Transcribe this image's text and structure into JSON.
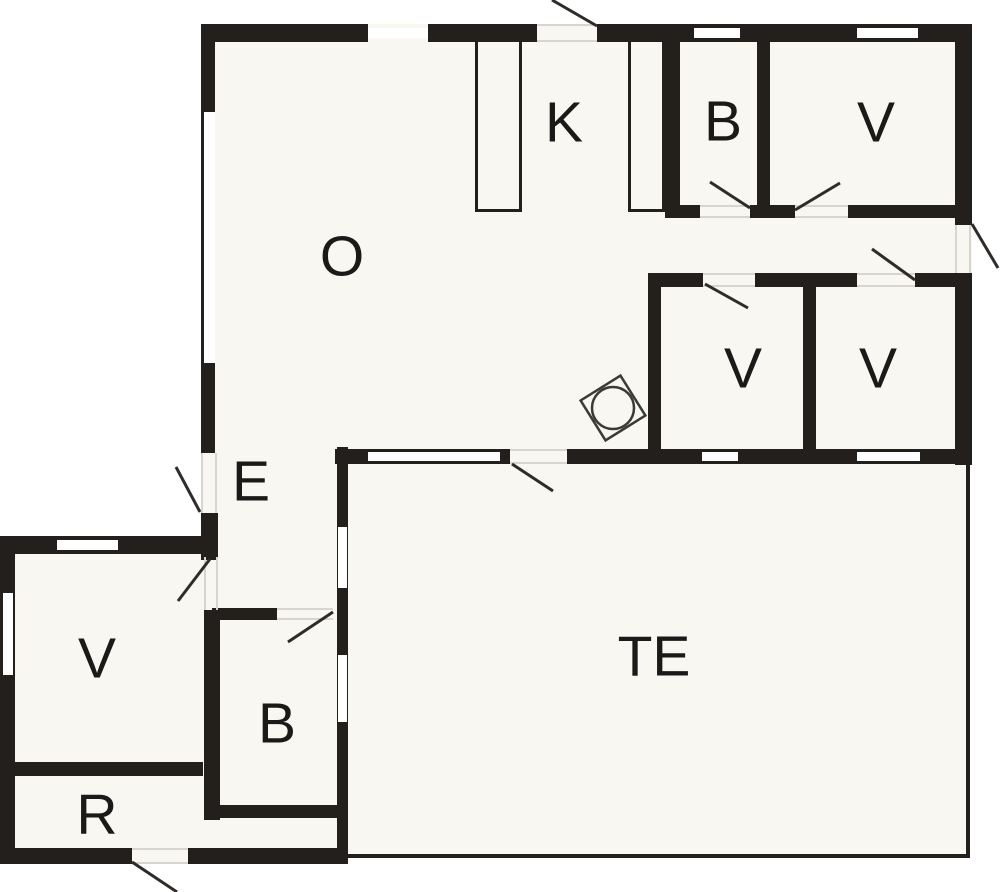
{
  "canvas": {
    "width": 1000,
    "height": 892
  },
  "colors": {
    "background": "#ffffff",
    "floor": "#f8f7f2",
    "wall": "#221f1c",
    "swing_line": "#2e2b28",
    "hairline": "#d8d5ce",
    "label": "#1c1a18",
    "washer_stroke": "#3a3a38"
  },
  "label_font_size": 57,
  "rooms": [
    {
      "id": "living-room",
      "label": "O",
      "x": 342,
      "y": 257
    },
    {
      "id": "kitchen",
      "label": "K",
      "x": 564,
      "y": 123
    },
    {
      "id": "bathroom-top",
      "label": "B",
      "x": 723,
      "y": 122
    },
    {
      "id": "bedroom-top-right",
      "label": "V",
      "x": 876,
      "y": 123
    },
    {
      "id": "bedroom-mid-left",
      "label": "V",
      "x": 743,
      "y": 369
    },
    {
      "id": "bedroom-mid-right",
      "label": "V",
      "x": 878,
      "y": 369
    },
    {
      "id": "entrance",
      "label": "E",
      "x": 251,
      "y": 482
    },
    {
      "id": "bedroom-lower-left",
      "label": "V",
      "x": 97,
      "y": 659
    },
    {
      "id": "storage-room",
      "label": "R",
      "x": 97,
      "y": 815
    },
    {
      "id": "bathroom-bottom",
      "label": "B",
      "x": 277,
      "y": 724
    },
    {
      "id": "terrace",
      "label": "TE",
      "x": 654,
      "y": 657
    }
  ],
  "fills": [
    [
      201,
      24,
      771,
      441
    ],
    [
      201,
      449,
      147,
      171
    ],
    [
      0,
      536,
      348,
      328
    ],
    [
      337,
      447,
      633,
      411
    ]
  ],
  "walls": [
    [
      201,
      24,
      167,
      18
    ],
    [
      428,
      24,
      109,
      18
    ],
    [
      597,
      24,
      375,
      18
    ],
    [
      201,
      24,
      14,
      429
    ],
    [
      201,
      513,
      17,
      47
    ],
    [
      955,
      24,
      17,
      201
    ],
    [
      955,
      273,
      17,
      192
    ],
    [
      665,
      42,
      15,
      176
    ],
    [
      757,
      42,
      13,
      176
    ],
    [
      665,
      205,
      35,
      13
    ],
    [
      750,
      205,
      45,
      13
    ],
    [
      848,
      205,
      124,
      13
    ],
    [
      648,
      273,
      55,
      14
    ],
    [
      755,
      273,
      102,
      14
    ],
    [
      915,
      273,
      57,
      14
    ],
    [
      648,
      273,
      13,
      177
    ],
    [
      803,
      273,
      13,
      191
    ],
    [
      335,
      449,
      175,
      15
    ],
    [
      567,
      449,
      405,
      15
    ],
    [
      337,
      447,
      11,
      417
    ],
    [
      204,
      610,
      16,
      210
    ],
    [
      0,
      536,
      212,
      18
    ],
    [
      0,
      536,
      15,
      328
    ],
    [
      15,
      762,
      188,
      14
    ],
    [
      0,
      848,
      132,
      16
    ],
    [
      188,
      848,
      160,
      16
    ],
    [
      212,
      608,
      65,
      12
    ],
    [
      204,
      805,
      133,
      13
    ],
    [
      966,
      464,
      4,
      394
    ],
    [
      348,
      854,
      622,
      4
    ]
  ],
  "partitions": [
    {
      "x": 475,
      "y": 42,
      "w": 47,
      "h": 170,
      "sides": "lrb"
    },
    {
      "x": 628,
      "y": 42,
      "w": 37,
      "h": 170,
      "sides": "lrb"
    }
  ],
  "windows": [
    [
      368,
      28,
      60,
      10
    ],
    [
      694,
      28,
      46,
      10
    ],
    [
      857,
      28,
      61,
      10
    ],
    [
      204,
      112,
      11,
      251
    ],
    [
      368,
      452,
      132,
      9
    ],
    [
      702,
      452,
      36,
      9
    ],
    [
      857,
      452,
      63,
      9
    ],
    [
      338,
      527,
      9,
      61
    ],
    [
      338,
      655,
      9,
      67
    ],
    [
      57,
      540,
      61,
      10
    ],
    [
      3,
      593,
      10,
      82
    ]
  ],
  "hairlines": [
    [
      537,
      24,
      60,
      2
    ],
    [
      537,
      40,
      60,
      2
    ],
    [
      955,
      225,
      2,
      48
    ],
    [
      969,
      225,
      2,
      48
    ],
    [
      700,
      205,
      50,
      2
    ],
    [
      700,
      216,
      50,
      2
    ],
    [
      795,
      205,
      53,
      2
    ],
    [
      795,
      216,
      53,
      2
    ],
    [
      703,
      273,
      52,
      2
    ],
    [
      703,
      285,
      52,
      2
    ],
    [
      857,
      273,
      58,
      2
    ],
    [
      857,
      285,
      58,
      2
    ],
    [
      510,
      449,
      57,
      2
    ],
    [
      510,
      462,
      57,
      2
    ],
    [
      201,
      453,
      2,
      60
    ],
    [
      215,
      453,
      2,
      60
    ],
    [
      204,
      557,
      2,
      53
    ],
    [
      216,
      557,
      2,
      53
    ],
    [
      277,
      608,
      56,
      2
    ],
    [
      277,
      618,
      56,
      2
    ],
    [
      132,
      848,
      56,
      2
    ],
    [
      132,
      862,
      56,
      2
    ]
  ],
  "swing_lines": [
    {
      "x1": 597,
      "y1": 26,
      "x2": 552,
      "y2": 0
    },
    {
      "x1": 750,
      "y1": 208,
      "x2": 710,
      "y2": 182
    },
    {
      "x1": 795,
      "y1": 210,
      "x2": 840,
      "y2": 183
    },
    {
      "x1": 972,
      "y1": 224,
      "x2": 998,
      "y2": 268
    },
    {
      "x1": 705,
      "y1": 284,
      "x2": 748,
      "y2": 308
    },
    {
      "x1": 915,
      "y1": 280,
      "x2": 872,
      "y2": 249
    },
    {
      "x1": 512,
      "y1": 464,
      "x2": 553,
      "y2": 491
    },
    {
      "x1": 200,
      "y1": 512,
      "x2": 176,
      "y2": 467
    },
    {
      "x1": 210,
      "y1": 559,
      "x2": 178,
      "y2": 601
    },
    {
      "x1": 333,
      "y1": 612,
      "x2": 288,
      "y2": 642
    },
    {
      "x1": 132,
      "y1": 862,
      "x2": 177,
      "y2": 892
    }
  ],
  "washer": {
    "cx": 613,
    "cy": 408,
    "size": 47,
    "rotation": -32,
    "circle_r": 21
  }
}
